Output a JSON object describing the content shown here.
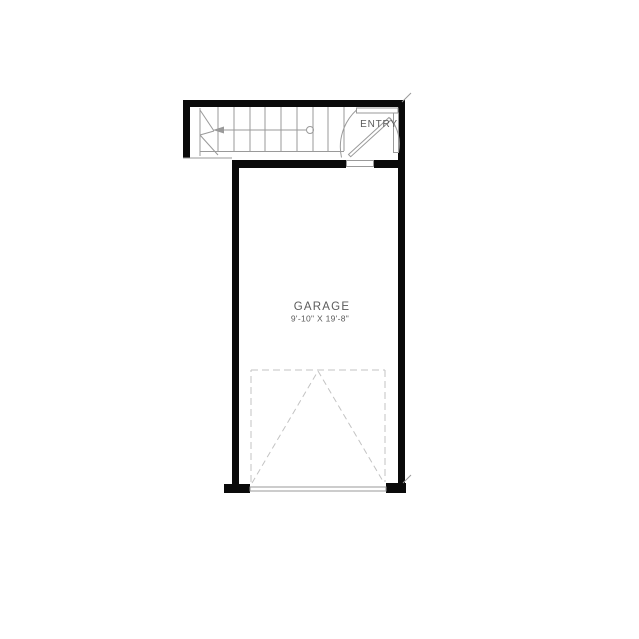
{
  "drawing": {
    "type": "floor-plan",
    "background": "#ffffff"
  },
  "colors": {
    "bg": "#ffffff",
    "wall": "#0a0a0a",
    "line": "#9a9a9a",
    "faint": "#c3c3c3",
    "text": "#5b5b5b"
  },
  "rooms": {
    "garage": {
      "label": "GARAGE",
      "dimensions": "9'-10\" X 19'-8\""
    },
    "entry": {
      "label": "ENTRY"
    }
  }
}
